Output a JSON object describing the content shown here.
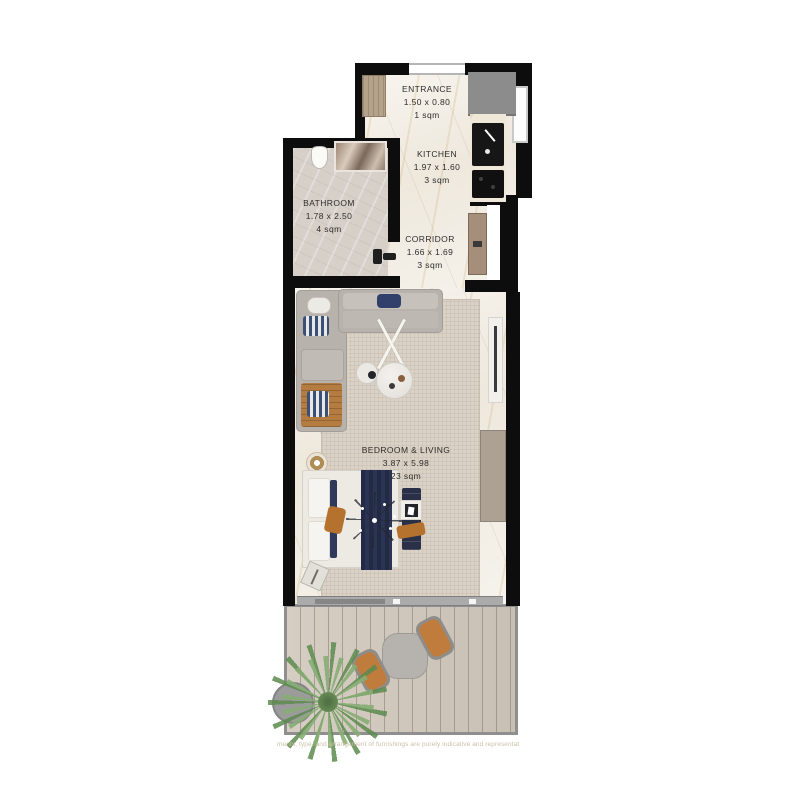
{
  "plan": {
    "rooms": {
      "entrance": {
        "name": "ENTRANCE",
        "dimensions": "1.50 x 0.80",
        "area": "1 sqm"
      },
      "kitchen": {
        "name": "KITCHEN",
        "dimensions": "1.97 x 1.60",
        "area": "3 sqm"
      },
      "bathroom": {
        "name": "BATHROOM",
        "dimensions": "1.78 x 2.50",
        "area": "4 sqm"
      },
      "corridor": {
        "name": "CORRIDOR",
        "dimensions": "1.66 x 1.69",
        "area": "3 sqm"
      },
      "bedroom_living": {
        "name": "BEDROOM & LIVING",
        "dimensions": "3.87 x 5.98",
        "area": "23 sqm"
      }
    },
    "disclaimer": "ments, type, and arrangement of furnishings are purely indicative and representat",
    "colors": {
      "wall": "#0d0d0d",
      "marble_floor": "#f5f2eb",
      "bathroom_tile": "#d7d0c9",
      "rug": "#dbd2c6",
      "deck_wood": "#d1c8bc",
      "sofa_gray": "#b7b3ac",
      "accent_navy": "#2b3350",
      "accent_orange": "#b5722f",
      "plant_green": "#5c8a4e",
      "door_wood": "#b5a28a"
    }
  }
}
